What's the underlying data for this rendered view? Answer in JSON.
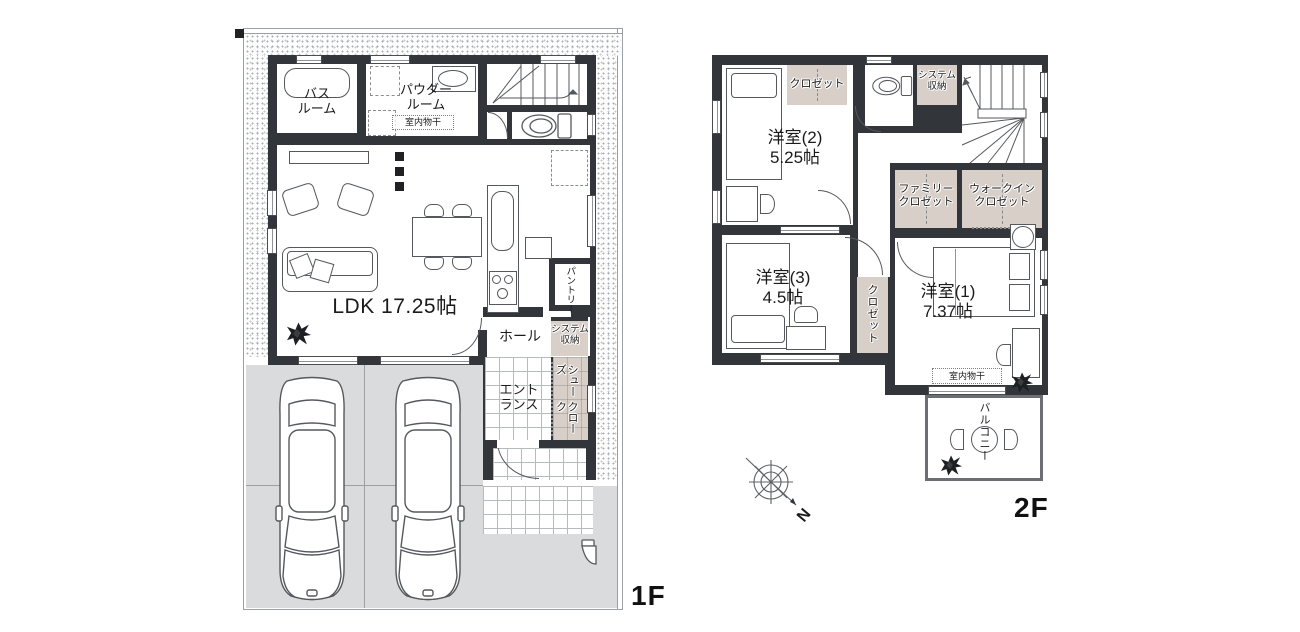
{
  "colors": {
    "wall": "#32353a",
    "storage_fill": "#d7cfc8",
    "paving_fill": "#d9dbdc",
    "text": "#1b1b1b"
  },
  "f1": {
    "floor_label": "1F",
    "rooms": {
      "bath": [
        "バス",
        "ルーム"
      ],
      "powder": [
        "パウダー",
        "ルーム"
      ],
      "powder_drying": "室内物干",
      "ldk": "LDK 17.25帖",
      "pantry": "パントリー",
      "system_storage": [
        "システム",
        "収納"
      ],
      "hall": "ホール",
      "entrance": [
        "エント",
        "ランス"
      ],
      "shoe_cloak": [
        "シューズ",
        "クローク"
      ]
    }
  },
  "f2": {
    "floor_label": "2F",
    "rooms": {
      "closet_top": "クロゼット",
      "system_storage": [
        "システム",
        "収納"
      ],
      "bedroom2": [
        "洋室(2)",
        "5.25帖"
      ],
      "family_closet": [
        "ファミリー",
        "クロゼット"
      ],
      "walkin_closet": [
        "ウォークイン",
        "クロゼット"
      ],
      "bedroom3": [
        "洋室(3)",
        "4.5帖"
      ],
      "closet_mid": "クロゼット",
      "bedroom1": [
        "洋室(1)",
        "7.37帖"
      ],
      "indoor_drying": "室内物干",
      "balcony": "バルコニー"
    }
  },
  "compass": {
    "north": "N"
  }
}
